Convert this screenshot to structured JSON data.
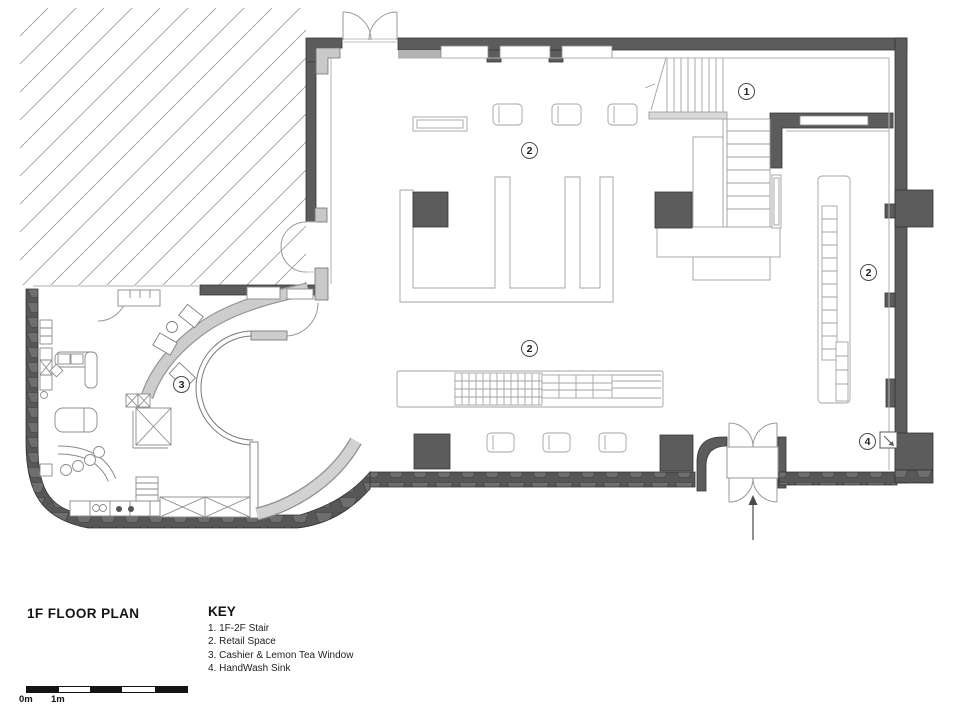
{
  "title": "1F FLOOR PLAN",
  "key": {
    "heading": "KEY",
    "items": [
      "1. 1F-2F Stair",
      "2. Retail Space",
      "3. Cashier & Lemon Tea Window",
      "4. HandWash Sink"
    ]
  },
  "plan_labels": [
    {
      "text": "1"
    },
    {
      "text": "2"
    },
    {
      "text": "2"
    },
    {
      "text": "2"
    },
    {
      "text": "3"
    },
    {
      "text": "4"
    }
  ],
  "scale_bar": {
    "label_start": "0m",
    "label_second": "1m"
  },
  "icons": {
    "entry_arrow": "arrow-up",
    "sink_arrow": "arrow-down-right"
  },
  "colors": {
    "wall": "#5c5c5c",
    "wall_outline": "#353535",
    "light_gray": "#cdcdcd",
    "line": "#9a9a9a",
    "text": "#141414"
  }
}
